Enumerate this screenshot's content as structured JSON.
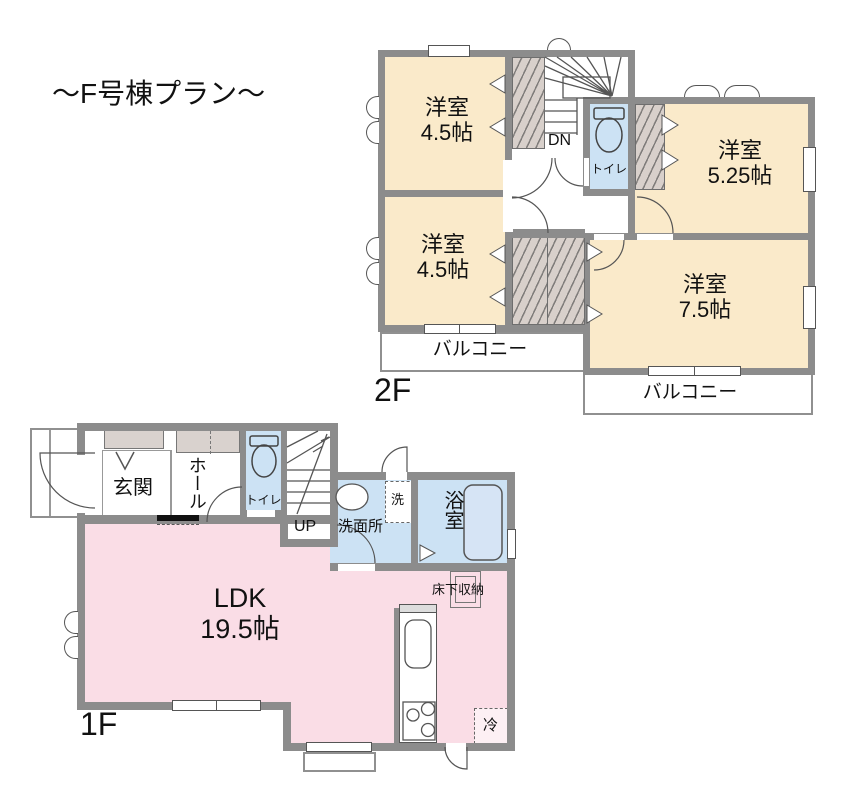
{
  "title": "〜F号棟プラン〜",
  "palette": {
    "wall": "#8C8C8C",
    "bedroom_fill": "#FAEACA",
    "ldk_fill": "#FADDE6",
    "water_fill": "#CCE2F4",
    "closet_fill": "#D8D0CB",
    "cabinet_fill": "#D9D2CE"
  },
  "floor2": {
    "label": "2F",
    "bedroom_top_left": {
      "name": "洋室",
      "size": "4.5帖"
    },
    "bedroom_bottom_left": {
      "name": "洋室",
      "size": "4.5帖"
    },
    "bedroom_right_upper": {
      "name": "洋室",
      "size": "5.25帖"
    },
    "bedroom_right_lower": {
      "name": "洋室",
      "size": "7.5帖"
    },
    "toilet_label": "トイレ",
    "stairs_label": "DN",
    "balcony_left_label": "バルコニー",
    "balcony_right_label": "バルコニー"
  },
  "floor1": {
    "label": "1F",
    "entrance_label": "玄関",
    "hall_label": "ホール",
    "toilet_label": "トイレ",
    "stairs_label": "UP",
    "washroom_label": "洗面所",
    "washer_label": "洗",
    "bath_label": "浴室",
    "ldk": {
      "name": "LDK",
      "size": "19.5帖"
    },
    "floor_storage_label": "床下収納",
    "fridge_label": "冷"
  }
}
